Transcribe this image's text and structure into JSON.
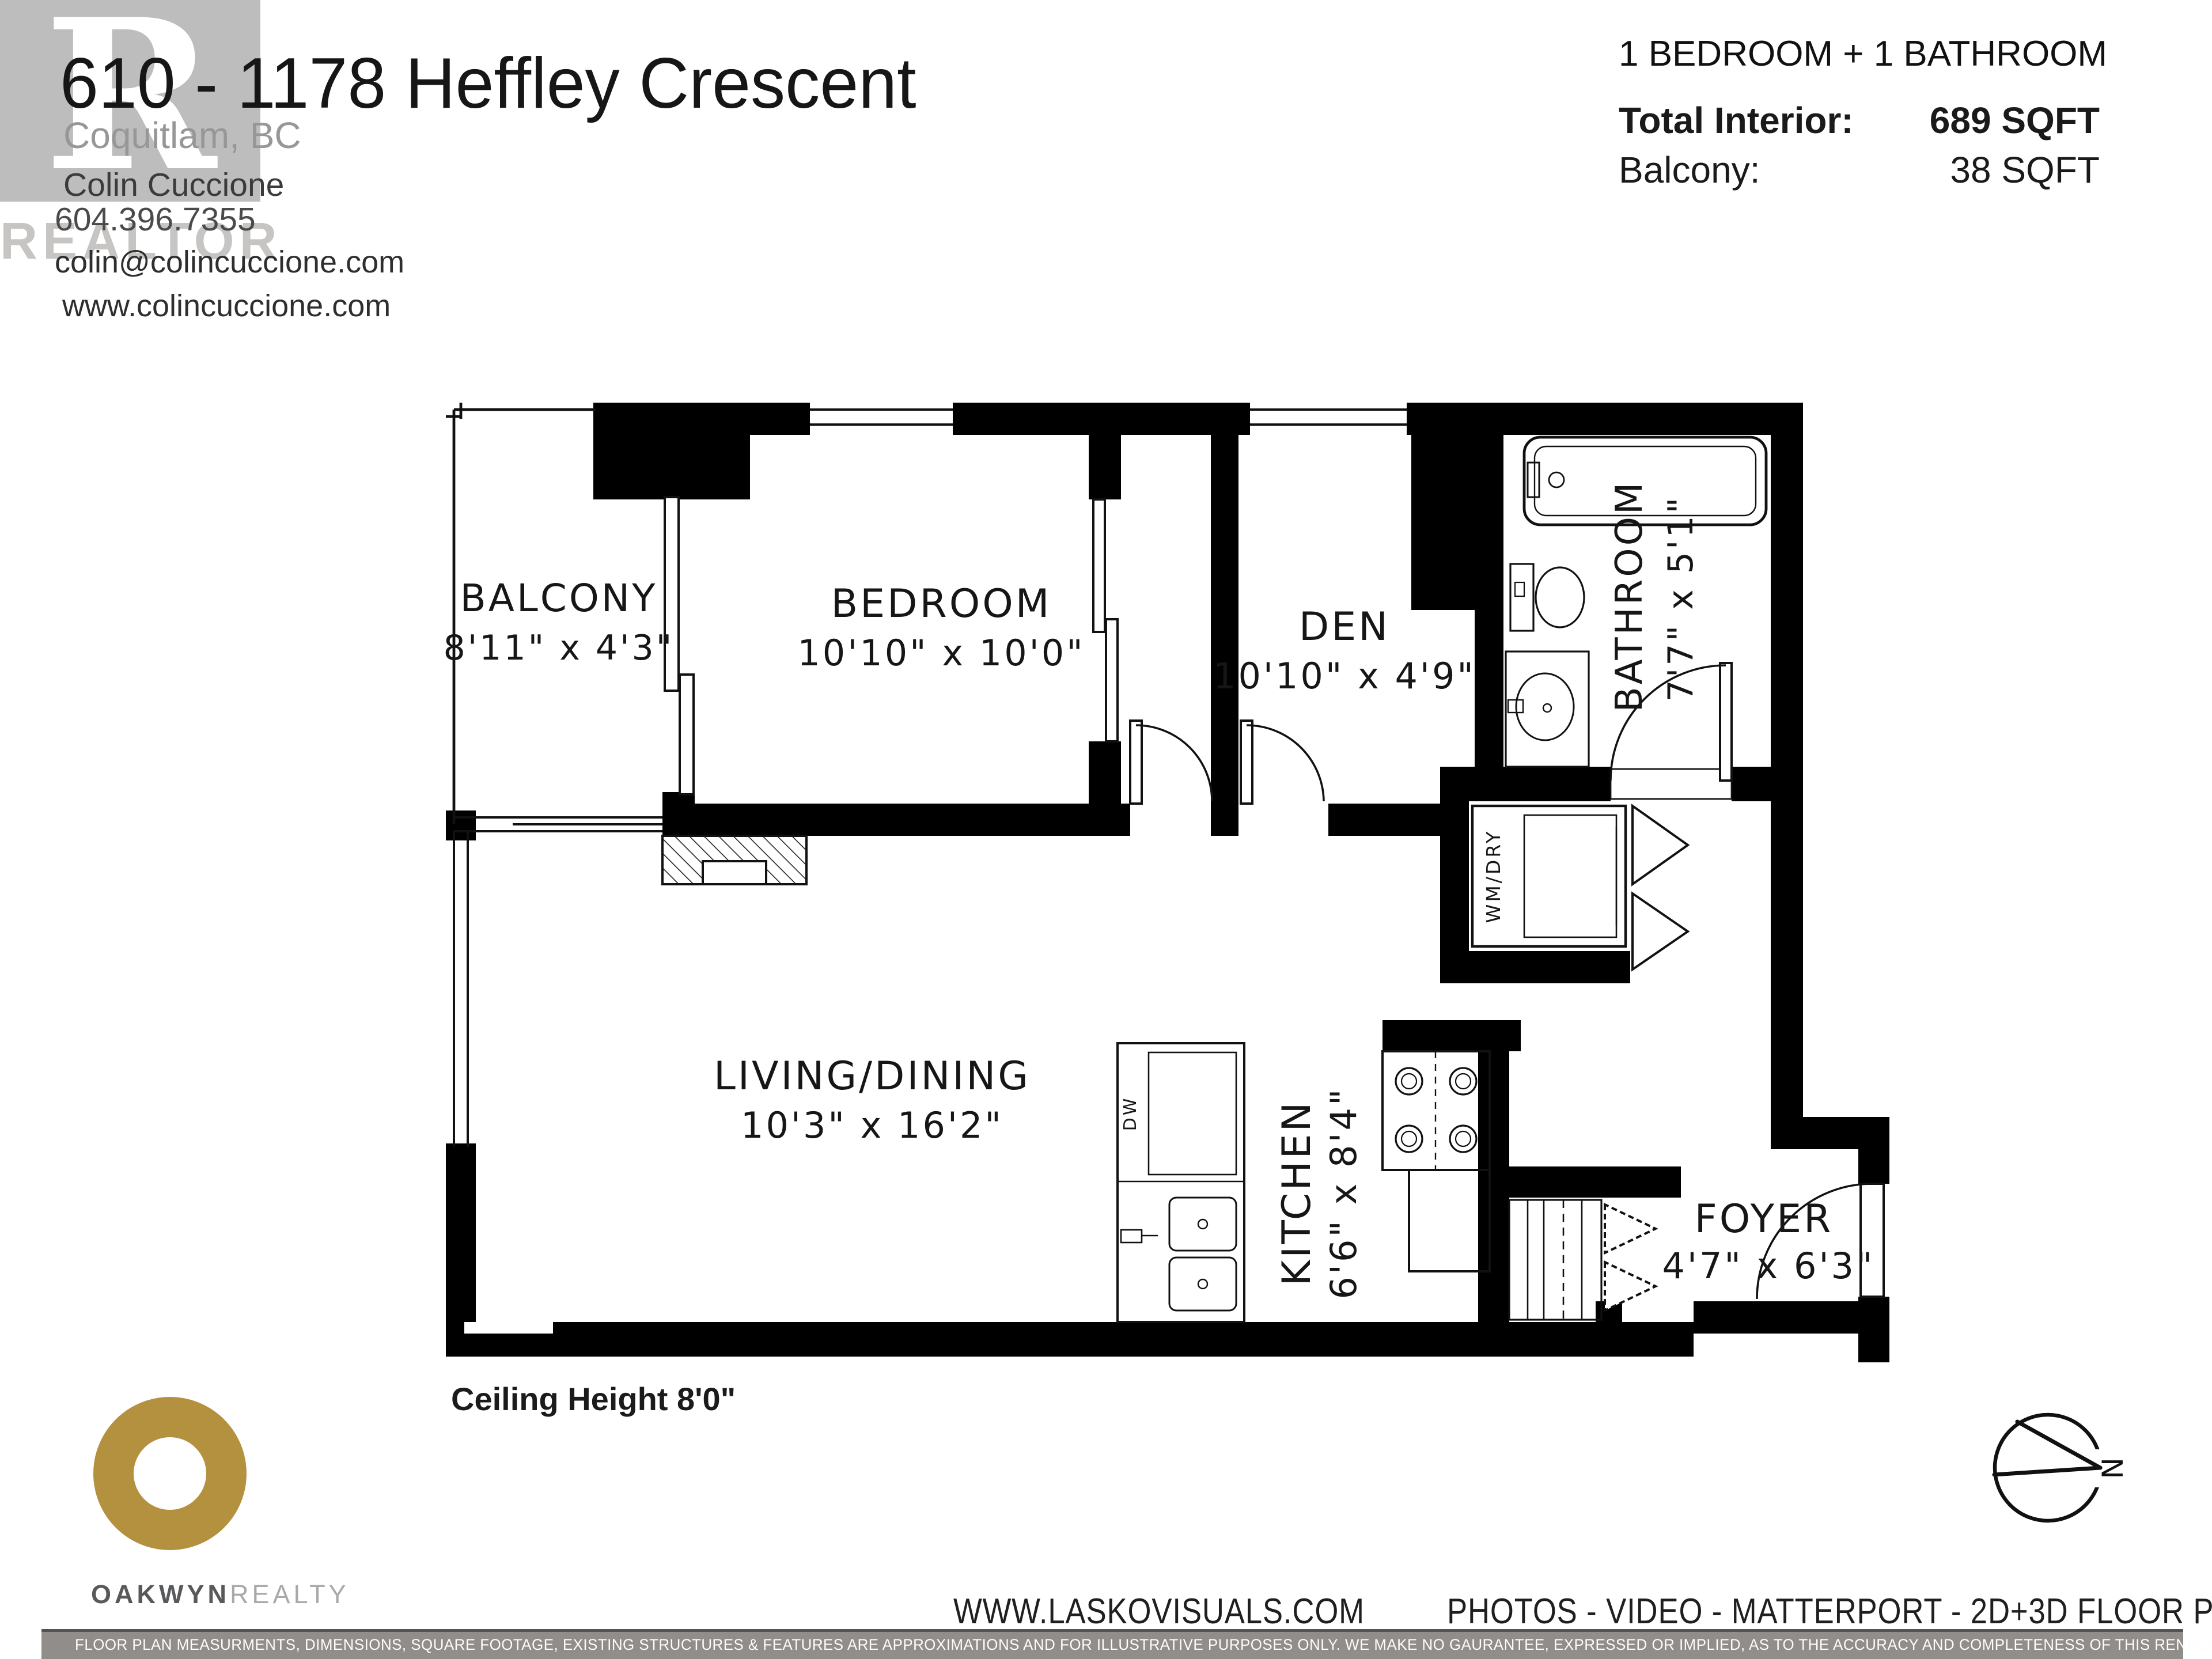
{
  "header": {
    "address": "610 - 1178 Heffley Crescent",
    "city": "Coquitlam, BC",
    "agent": "Colin Cuccione",
    "phone": "604.396.7355",
    "email": "colin@colincuccione.com",
    "website": "www.colincuccione.com",
    "watermark_letter": "R",
    "watermark_word": "REALTOR"
  },
  "summary": {
    "title": "1 BEDROOM + 1 BATHROOM",
    "total_interior_label": "Total Interior:",
    "total_interior_value": "689 SQFT",
    "balcony_label": "Balcony:",
    "balcony_value": "38 SQFT"
  },
  "plan": {
    "rooms": [
      {
        "name": "BALCONY",
        "dims": "8'11\" x 4'3\""
      },
      {
        "name": "BEDROOM",
        "dims": "10'10\" x 10'0\""
      },
      {
        "name": "DEN",
        "dims": "10'10\" x 4'9\""
      },
      {
        "name": "BATHROOM",
        "dims": "7'7\" x 5'1\""
      },
      {
        "name": "LIVING/DINING",
        "dims": "10'3\" x 16'2\""
      },
      {
        "name": "KITCHEN",
        "dims": "6'6\" x 8'4\""
      },
      {
        "name": "FOYER",
        "dims": "4'7\" x 6'3\""
      }
    ],
    "labels": {
      "washer_dryer": "WM/DRY",
      "dishwasher": "DW",
      "ceiling_height": "Ceiling Height 8'0\"",
      "compass_north": "N"
    }
  },
  "footer": {
    "brokerage_name": "OAKWYN",
    "brokerage_suffix": "REALTY",
    "photographer_site": "WWW.LASKOVISUALS.COM",
    "services": "PHOTOS - VIDEO - MATTERPORT - 2D+3D FLOOR PLANS",
    "disclaimer": "FLOOR PLAN MEASURMENTS, DIMENSIONS, SQUARE FOOTAGE, EXISTING STRUCTURES & FEATURES ARE APPROXIMATIONS AND FOR ILLUSTRATIVE PURPOSES ONLY. WE MAKE NO GAURANTEE, EXPRESSED OR IMPLIED, AS TO THE ACCURACY AND COMPLETENESS OF THIS RENDERING. INDEPENDENT VERIFICATION RECOMMENDED"
  },
  "colors": {
    "wall": "#000000",
    "brand_gold": "#B3913F",
    "disclaimer_bg": "#908D8A",
    "watermark_gray": "#BDBDBD"
  }
}
